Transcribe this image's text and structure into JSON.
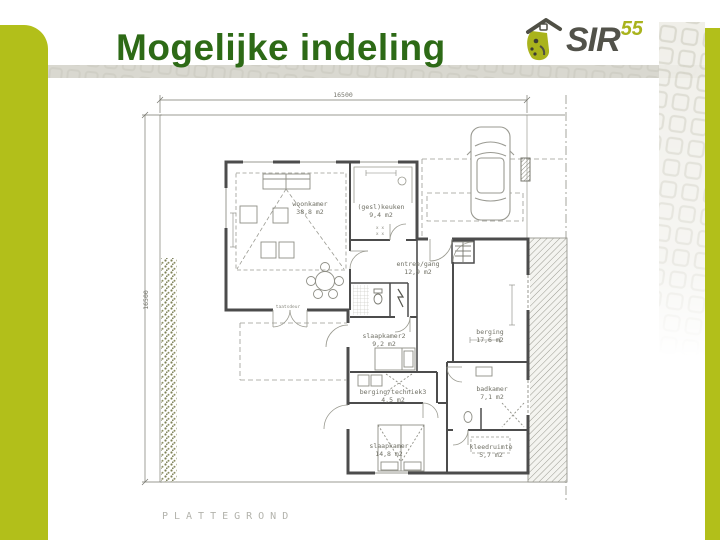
{
  "slide": {
    "title": "Mogelijke indeling"
  },
  "palette": {
    "accent": "#b2bf1a",
    "title_green": "#2d6a16",
    "logo_text_color": "#52524a",
    "logo_accent": "#a9b31c"
  },
  "logo": {
    "name": "SIR",
    "superscript": "55"
  },
  "floorplan": {
    "caption": "PLATTEGROND",
    "dim_top": "16500",
    "dim_left": "16500",
    "door_label": "taatsdeur",
    "kitchen_marks": "x x",
    "rooms": [
      {
        "name": "woonkamer",
        "area": "38,8 m2"
      },
      {
        "name": "(gesl)keuken",
        "area": "9,4 m2"
      },
      {
        "name": "entree/gang",
        "area": "12,9 m2"
      },
      {
        "name": "slaapkamer2",
        "area": "9,2 m2"
      },
      {
        "name": "berging",
        "area": "17,6 m2"
      },
      {
        "name": "berging/techniek3",
        "area": "4,5 m2"
      },
      {
        "name": "badkamer",
        "area": "7,1 m2"
      },
      {
        "name": "slaapkamer",
        "area": "14,8 m2"
      },
      {
        "name": "kleedruimte",
        "area": "5,7 m2"
      }
    ]
  }
}
